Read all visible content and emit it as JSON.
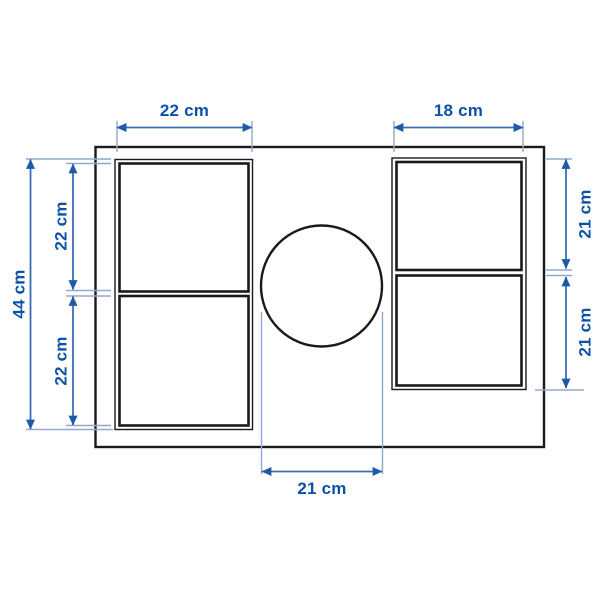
{
  "diagram": {
    "type": "product-dimension-diagram",
    "unit": "cm",
    "labels": {
      "top_left_width": "22 cm",
      "top_right_width": "18 cm",
      "overall_height": "44 cm",
      "left_upper_height": "22 cm",
      "left_lower_height": "22 cm",
      "right_upper_height": "21 cm",
      "right_lower_height": "21 cm",
      "circle_diameter": "21 cm"
    },
    "values_cm": {
      "top_left_width": 22,
      "top_right_width": 18,
      "overall_height": 44,
      "left_upper_height": 22,
      "left_lower_height": 22,
      "right_upper_height": 21,
      "right_lower_height": 21,
      "circle_diameter": 21
    },
    "colors": {
      "dimension_text": "#0a52a5",
      "dimension_line": "#3a6db4",
      "extension_line": "#8fa9d0",
      "arrow": "#1f5aa8",
      "outline": "#1a1a1a",
      "background": "#ffffff"
    }
  }
}
